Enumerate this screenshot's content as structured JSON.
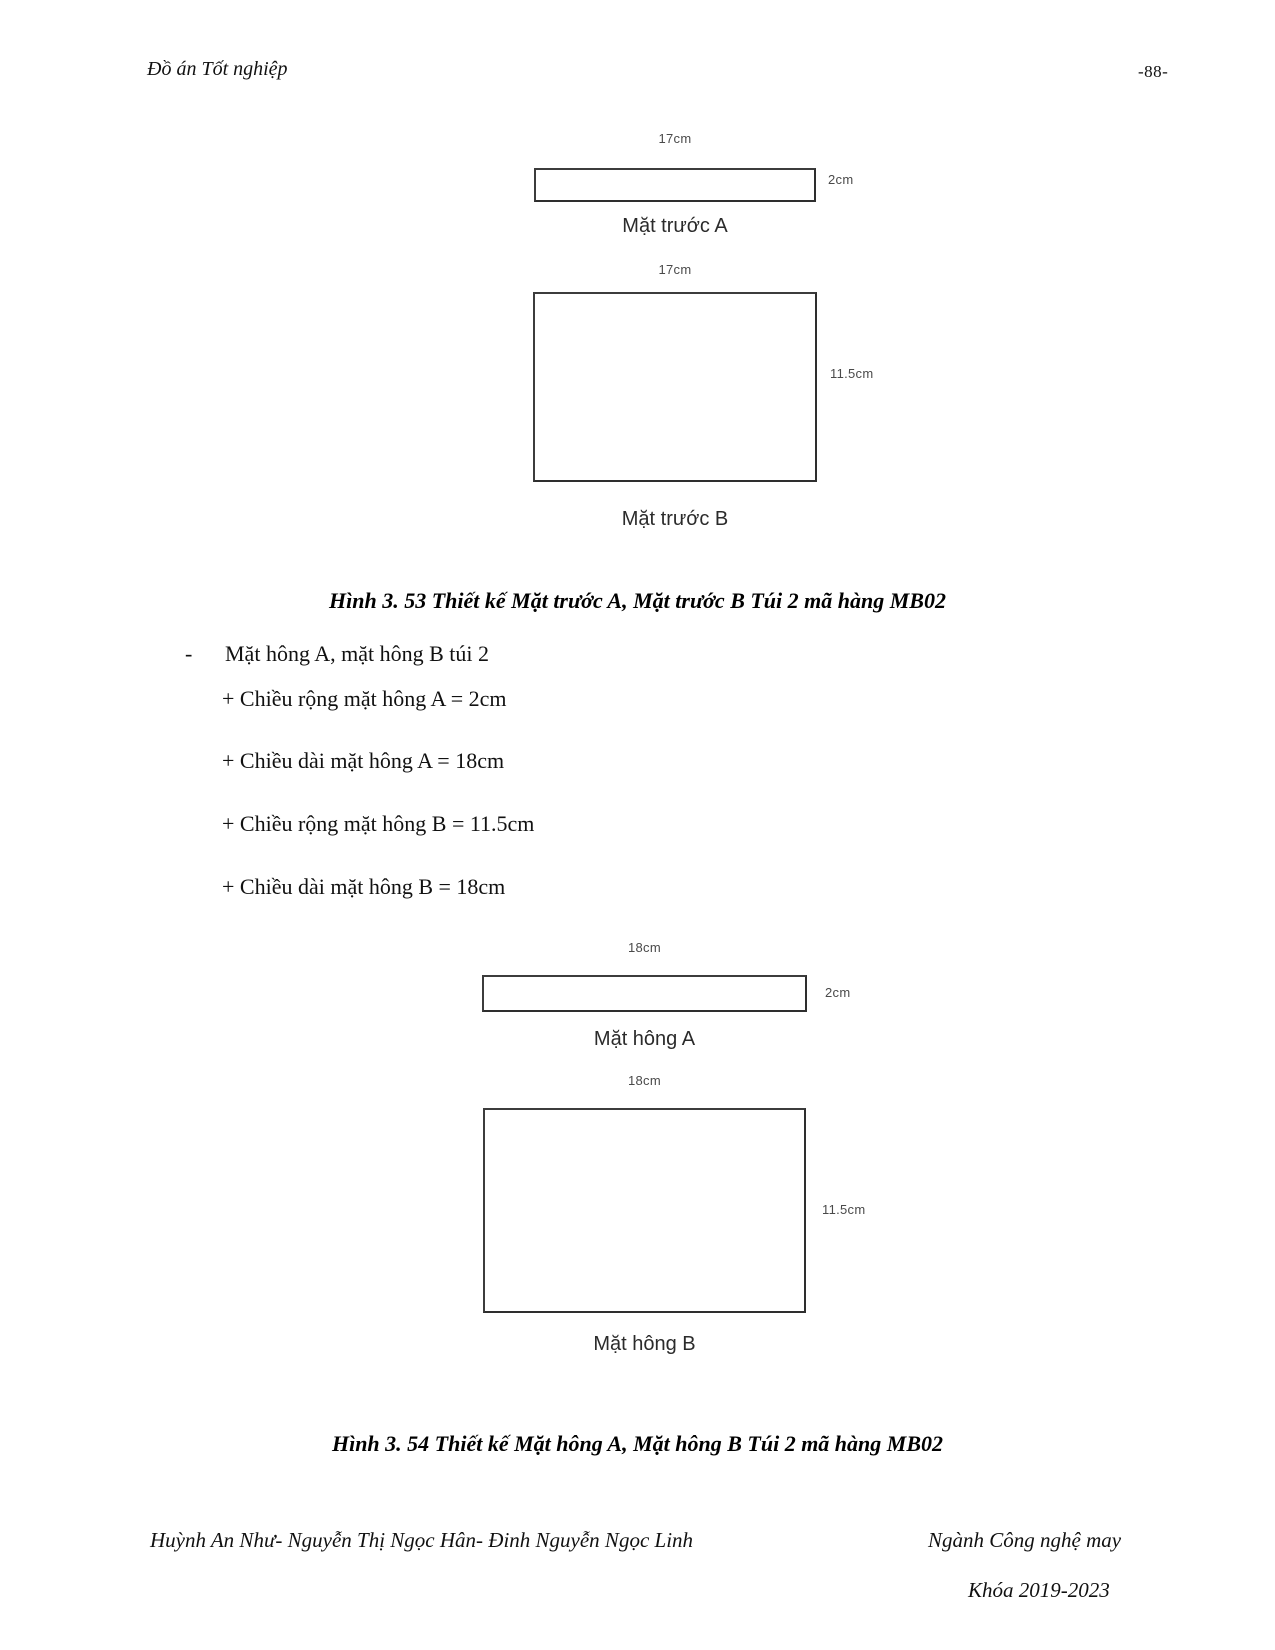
{
  "header": {
    "doc_title": "Đồ án Tốt nghiệp",
    "page_number": "-88-"
  },
  "figure53": {
    "shape_a": {
      "width_label": "17cm",
      "height_label": "2cm",
      "name": "Mặt trước A"
    },
    "shape_b": {
      "width_label": "17cm",
      "height_label": "11.5cm",
      "name": "Mặt trước B"
    },
    "caption": "Hình 3. 53 Thiết kế Mặt trước A, Mặt trước B Túi 2 mã hàng MB02"
  },
  "spec_list": {
    "marker": "-",
    "title": "Mặt hông A, mặt hông B túi 2",
    "items": [
      "+ Chiều rộng mặt hông A = 2cm",
      "+ Chiều dài mặt hông A = 18cm",
      "+ Chiều rộng mặt hông B = 11.5cm",
      "+ Chiều dài mặt hông B = 18cm"
    ]
  },
  "figure54": {
    "shape_a": {
      "width_label": "18cm",
      "height_label": "2cm",
      "name": "Mặt hông A"
    },
    "shape_b": {
      "width_label": "18cm",
      "height_label": "11.5cm",
      "name": "Mặt hông B"
    },
    "caption": "Hình 3. 54 Thiết kế Mặt hông A, Mặt hông B Túi 2 mã hàng MB02"
  },
  "footer": {
    "authors": "Huỳnh An Như- Nguyễn Thị Ngọc Hân- Đinh Nguyễn Ngọc Linh",
    "department": "Ngành Công nghệ may",
    "cohort": "Khóa 2019-2023"
  },
  "colors": {
    "text": "#111111",
    "shape_line": "#3c3c3c",
    "dim_label": "#4a4a4a",
    "background": "#ffffff"
  }
}
